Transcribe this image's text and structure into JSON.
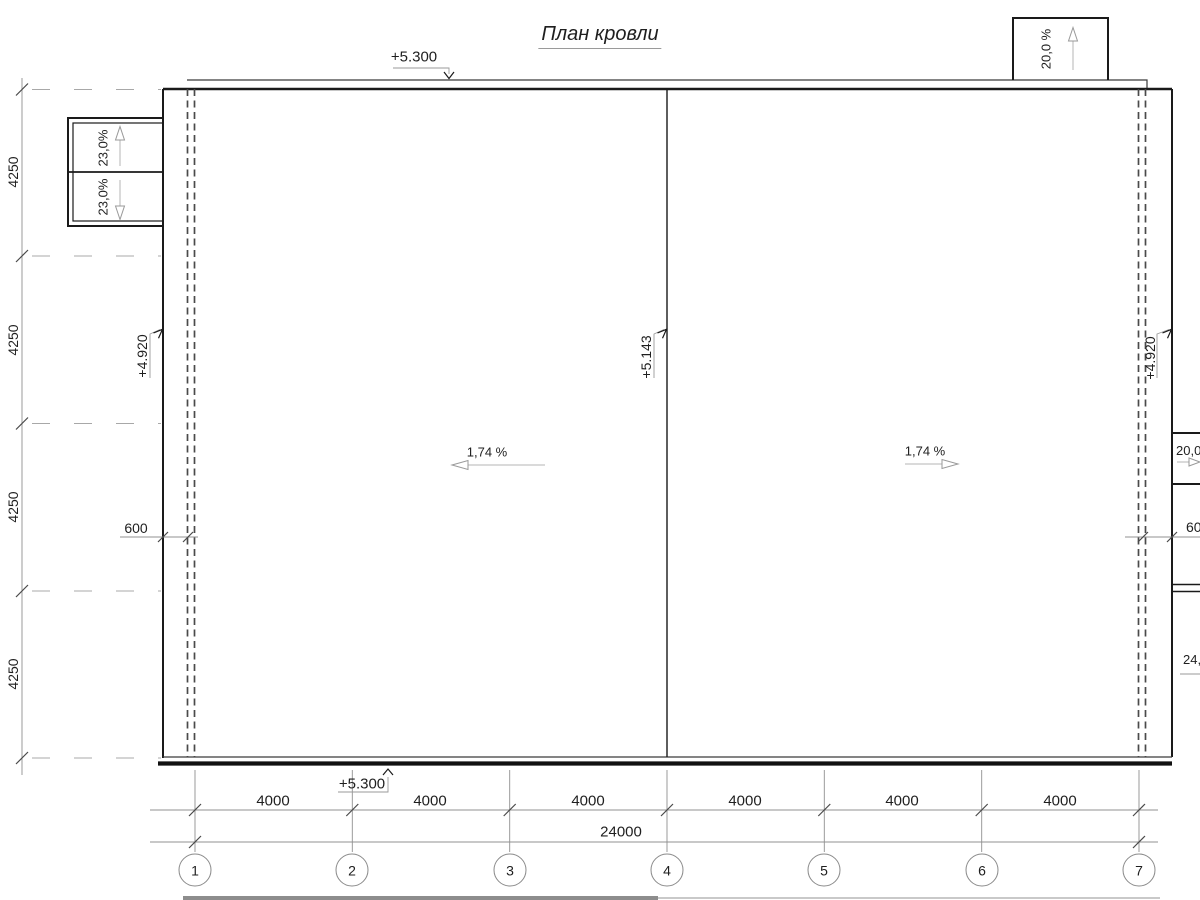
{
  "title": "План кровли",
  "labels": {
    "elev_top": "+5.300",
    "elev_bottom": "+5.300",
    "elev_left": "+4.920",
    "elev_right": "+4.920",
    "elev_ridge": "+5.143",
    "slope_left_roof": "1,74 %",
    "slope_right_roof": "1,74 %",
    "canopy_slope_upper": "23,0%",
    "canopy_slope_lower": "23,0%",
    "topbox_slope": "20,0 %",
    "rightbox_slope": "20,0 %",
    "rightbox_lower_slope": "24,0 %",
    "parapet_width_left": "600",
    "parapet_width_right": "600",
    "total_width": "24000"
  },
  "axis_rows": {
    "spacings": [
      "4250",
      "4250",
      "4250",
      "4250"
    ]
  },
  "axis_cols": {
    "numbers": [
      "1",
      "2",
      "3",
      "4",
      "5",
      "6",
      "7"
    ],
    "bays": [
      "4000",
      "4000",
      "4000",
      "4000",
      "4000",
      "4000"
    ]
  },
  "colors": {
    "background": "#ffffff",
    "line_dark": "#1a1a1a",
    "line_dim": "#909090",
    "text": "#1f1f1f"
  }
}
